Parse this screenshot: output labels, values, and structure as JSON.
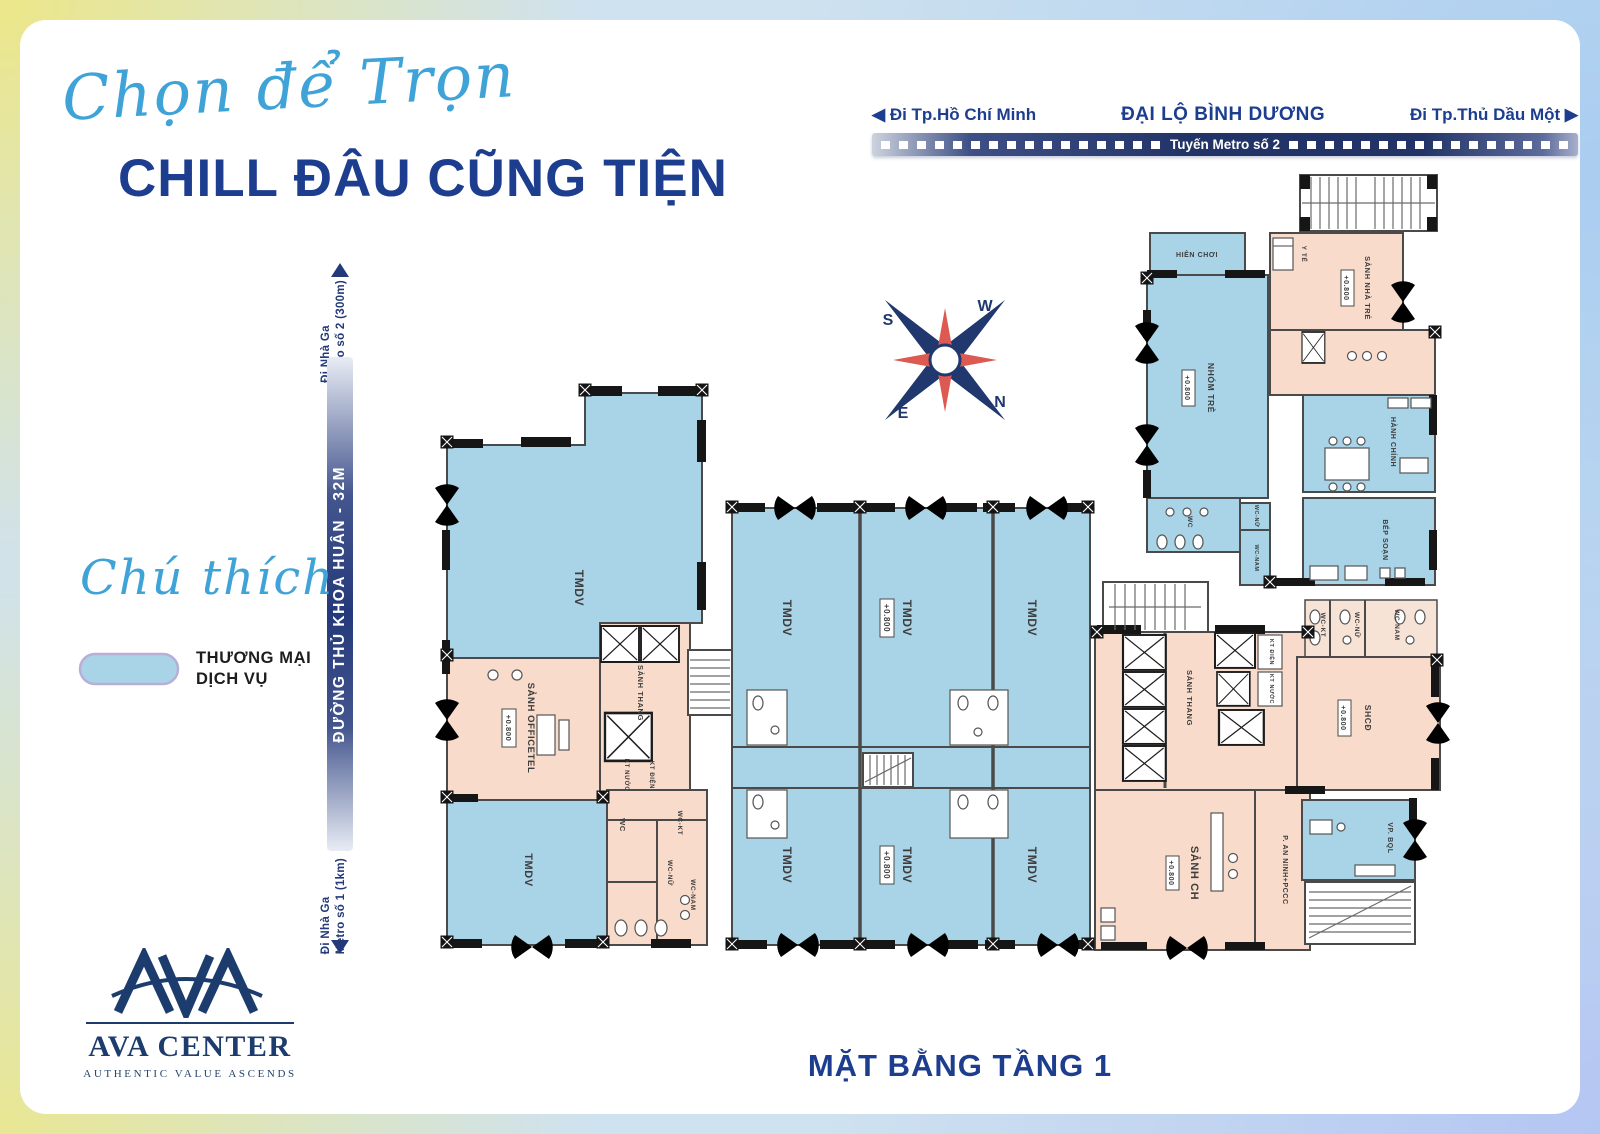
{
  "header": {
    "script_title": "Chọn để Trọn",
    "main_title": "CHILL ĐÂU CŨNG TIỆN"
  },
  "road_top": {
    "arrow_left": "◀",
    "dest_left": "Đi Tp.Hồ Chí Minh",
    "name": "ĐẠI LỘ BÌNH DƯƠNG",
    "dest_right": "Đi Tp.Thủ Dầu Một",
    "arrow_right": "▶",
    "metro_line": "Tuyến Metro số 2"
  },
  "road_left": {
    "name": "ĐƯỜNG THỦ KHOA HUÂN - 32M",
    "top_dest_line1": "Đi Nhà Ga",
    "top_dest_line2": "Metro số 2 (300m)",
    "bottom_dest_line1": "Đi Nhà Ga",
    "bottom_dest_line2": "Metro số 1 (1km)"
  },
  "legend": {
    "title": "Chú thích",
    "items": [
      {
        "label_line1": "THƯƠNG MẠI",
        "label_line2": "DỊCH VỤ",
        "color": "#a9d3e6"
      }
    ]
  },
  "compass": {
    "s": "S",
    "w": "W",
    "e": "E",
    "n": "N"
  },
  "plan": {
    "labels": {
      "tmdv": "TMDV",
      "elevation": "+0.800",
      "sanh_officetel": "SẢNH OFFICETEL",
      "sanh_thang": "SẢNH THANG",
      "sanh_ch": "SẢNH CH",
      "p_an_ninh": "P. AN NINH+PCCC",
      "shcd": "SHCĐ",
      "vp_bql": "VP. BQL",
      "wc": "WC",
      "wc_kt": "WC-KT",
      "wc_nu": "WC-NỮ",
      "wc_nam": "WC-NAM",
      "kt_dien": "KT ĐIỆN",
      "kt_nuoc": "KT NƯỚC",
      "hien_choi": "HIÊN CHƠI",
      "nhom_tre": "NHÓM TRẺ",
      "y_te": "Y TẾ",
      "sanh_nha_tre": "SẢNH NHÀ TRẺ",
      "hanh_chinh": "HÀNH CHÍNH",
      "bep_soan": "BẾP SOẠN"
    }
  },
  "logo": {
    "name": "AVA CENTER",
    "tagline": "AUTHENTIC VALUE ASCENDS"
  },
  "footer": {
    "title": "MẶT BẰNG TẦNG 1"
  },
  "colors": {
    "commercial_blue": "#a9d3e6",
    "service_pink": "#f8dbca",
    "navy": "#1d3d8f",
    "script_blue": "#3fa3d7",
    "road_navy": "#223467",
    "compass_red": "#dd5a52",
    "wall_dark": "#3a3a3a"
  }
}
